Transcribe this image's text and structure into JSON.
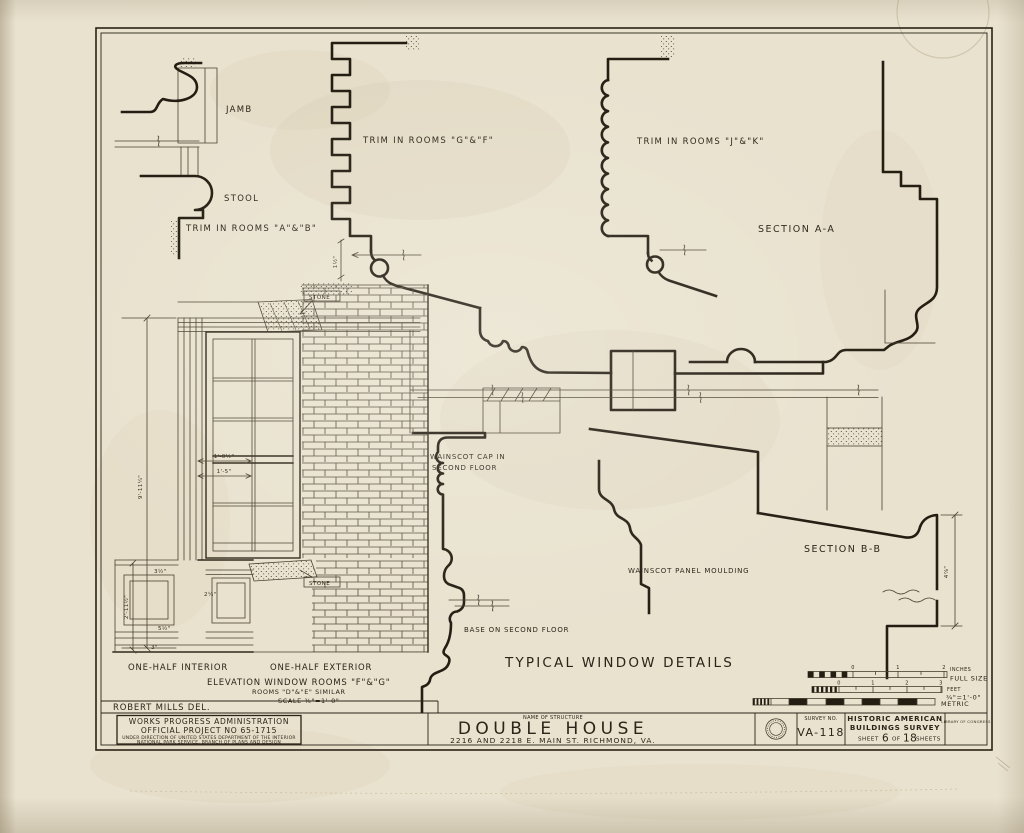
{
  "colors": {
    "paper": "#e9e2cf",
    "ink": "#241d12",
    "thin_ink": "#4a4030",
    "stain": "#d8cdb2"
  },
  "labels": {
    "jamb": "JAMB",
    "stool": "STOOL",
    "trim_ab": "TRIM IN ROOMS \"A\"&\"B\"",
    "trim_gf": "TRIM IN ROOMS \"G\"&\"F\"",
    "trim_jk": "TRIM IN ROOMS \"J\"&\"K\"",
    "section_aa": "SECTION A-A",
    "section_bb": "SECTION B-B",
    "wainscot_cap_1": "WAINSCOT CAP IN",
    "wainscot_cap_2": "SECOND FLOOR",
    "wainscot_panel": "WAINSCOT PANEL MOULDING",
    "base_second": "BASE ON SECOND FLOOR",
    "one_half_interior": "ONE-HALF INTERIOR",
    "one_half_exterior": "ONE-HALF EXTERIOR",
    "elevation_1": "ELEVATION WINDOW ROOMS \"F\"&\"G\"",
    "elevation_2": "ROOMS \"D\"&\"E\" SIMILAR",
    "elevation_3": "SCALE ¾\"=1'-0\"",
    "stone": "STONE",
    "typical_title": "TYPICAL WINDOW DETAILS",
    "delineator": "ROBERT MILLS DEL."
  },
  "dims": {
    "window_height": "9'-11¼\"",
    "width_1": "1'-0½\"",
    "width_2": "1'-5\"",
    "wainscot_height": "2'-11½\"",
    "d_3half": "3½\"",
    "d_5half": "5½\"",
    "d_3": "3\"",
    "d_2quarter": "2¼\"",
    "d_1half": "1½\"",
    "bb_height": "4⅞\""
  },
  "scale_bars": {
    "inches": {
      "ticks": [
        "0",
        "1",
        "2"
      ],
      "unit": "INCHES",
      "note": "FULL SIZE"
    },
    "feet": {
      "ticks": [
        "0",
        "1",
        "2",
        "3"
      ],
      "unit": "FEET",
      "note": "¾\"=1'-0\""
    },
    "metric": {
      "label": "METRIC"
    }
  },
  "title_block": {
    "agency_1": "WORKS PROGRESS ADMINISTRATION",
    "agency_2": "OFFICIAL PROJECT NO 65-1715",
    "agency_3": "UNDER DIRECTION OF UNITED STATES DEPARTMENT OF THE INTERIOR",
    "agency_4": "NATIONAL PARK SERVICE, BRANCH OF PLANS AND DESIGN",
    "name_of_structure_label": "NAME OF STRUCTURE",
    "structure_name": "DOUBLE HOUSE",
    "structure_address": "2216 AND 2218 E. MAIN ST.  RICHMOND, VA.",
    "survey_no_label": "SURVEY NO.",
    "survey_no": "VA-118",
    "org_1": "HISTORIC AMERICAN",
    "org_2": "BUILDINGS SURVEY",
    "sheet_word": "SHEET",
    "sheet_no": "6",
    "of_word": "OF",
    "sheet_total": "18",
    "sheets_word": "SHEETS",
    "loc_line": "LIBRARY OF CONGRESS"
  }
}
